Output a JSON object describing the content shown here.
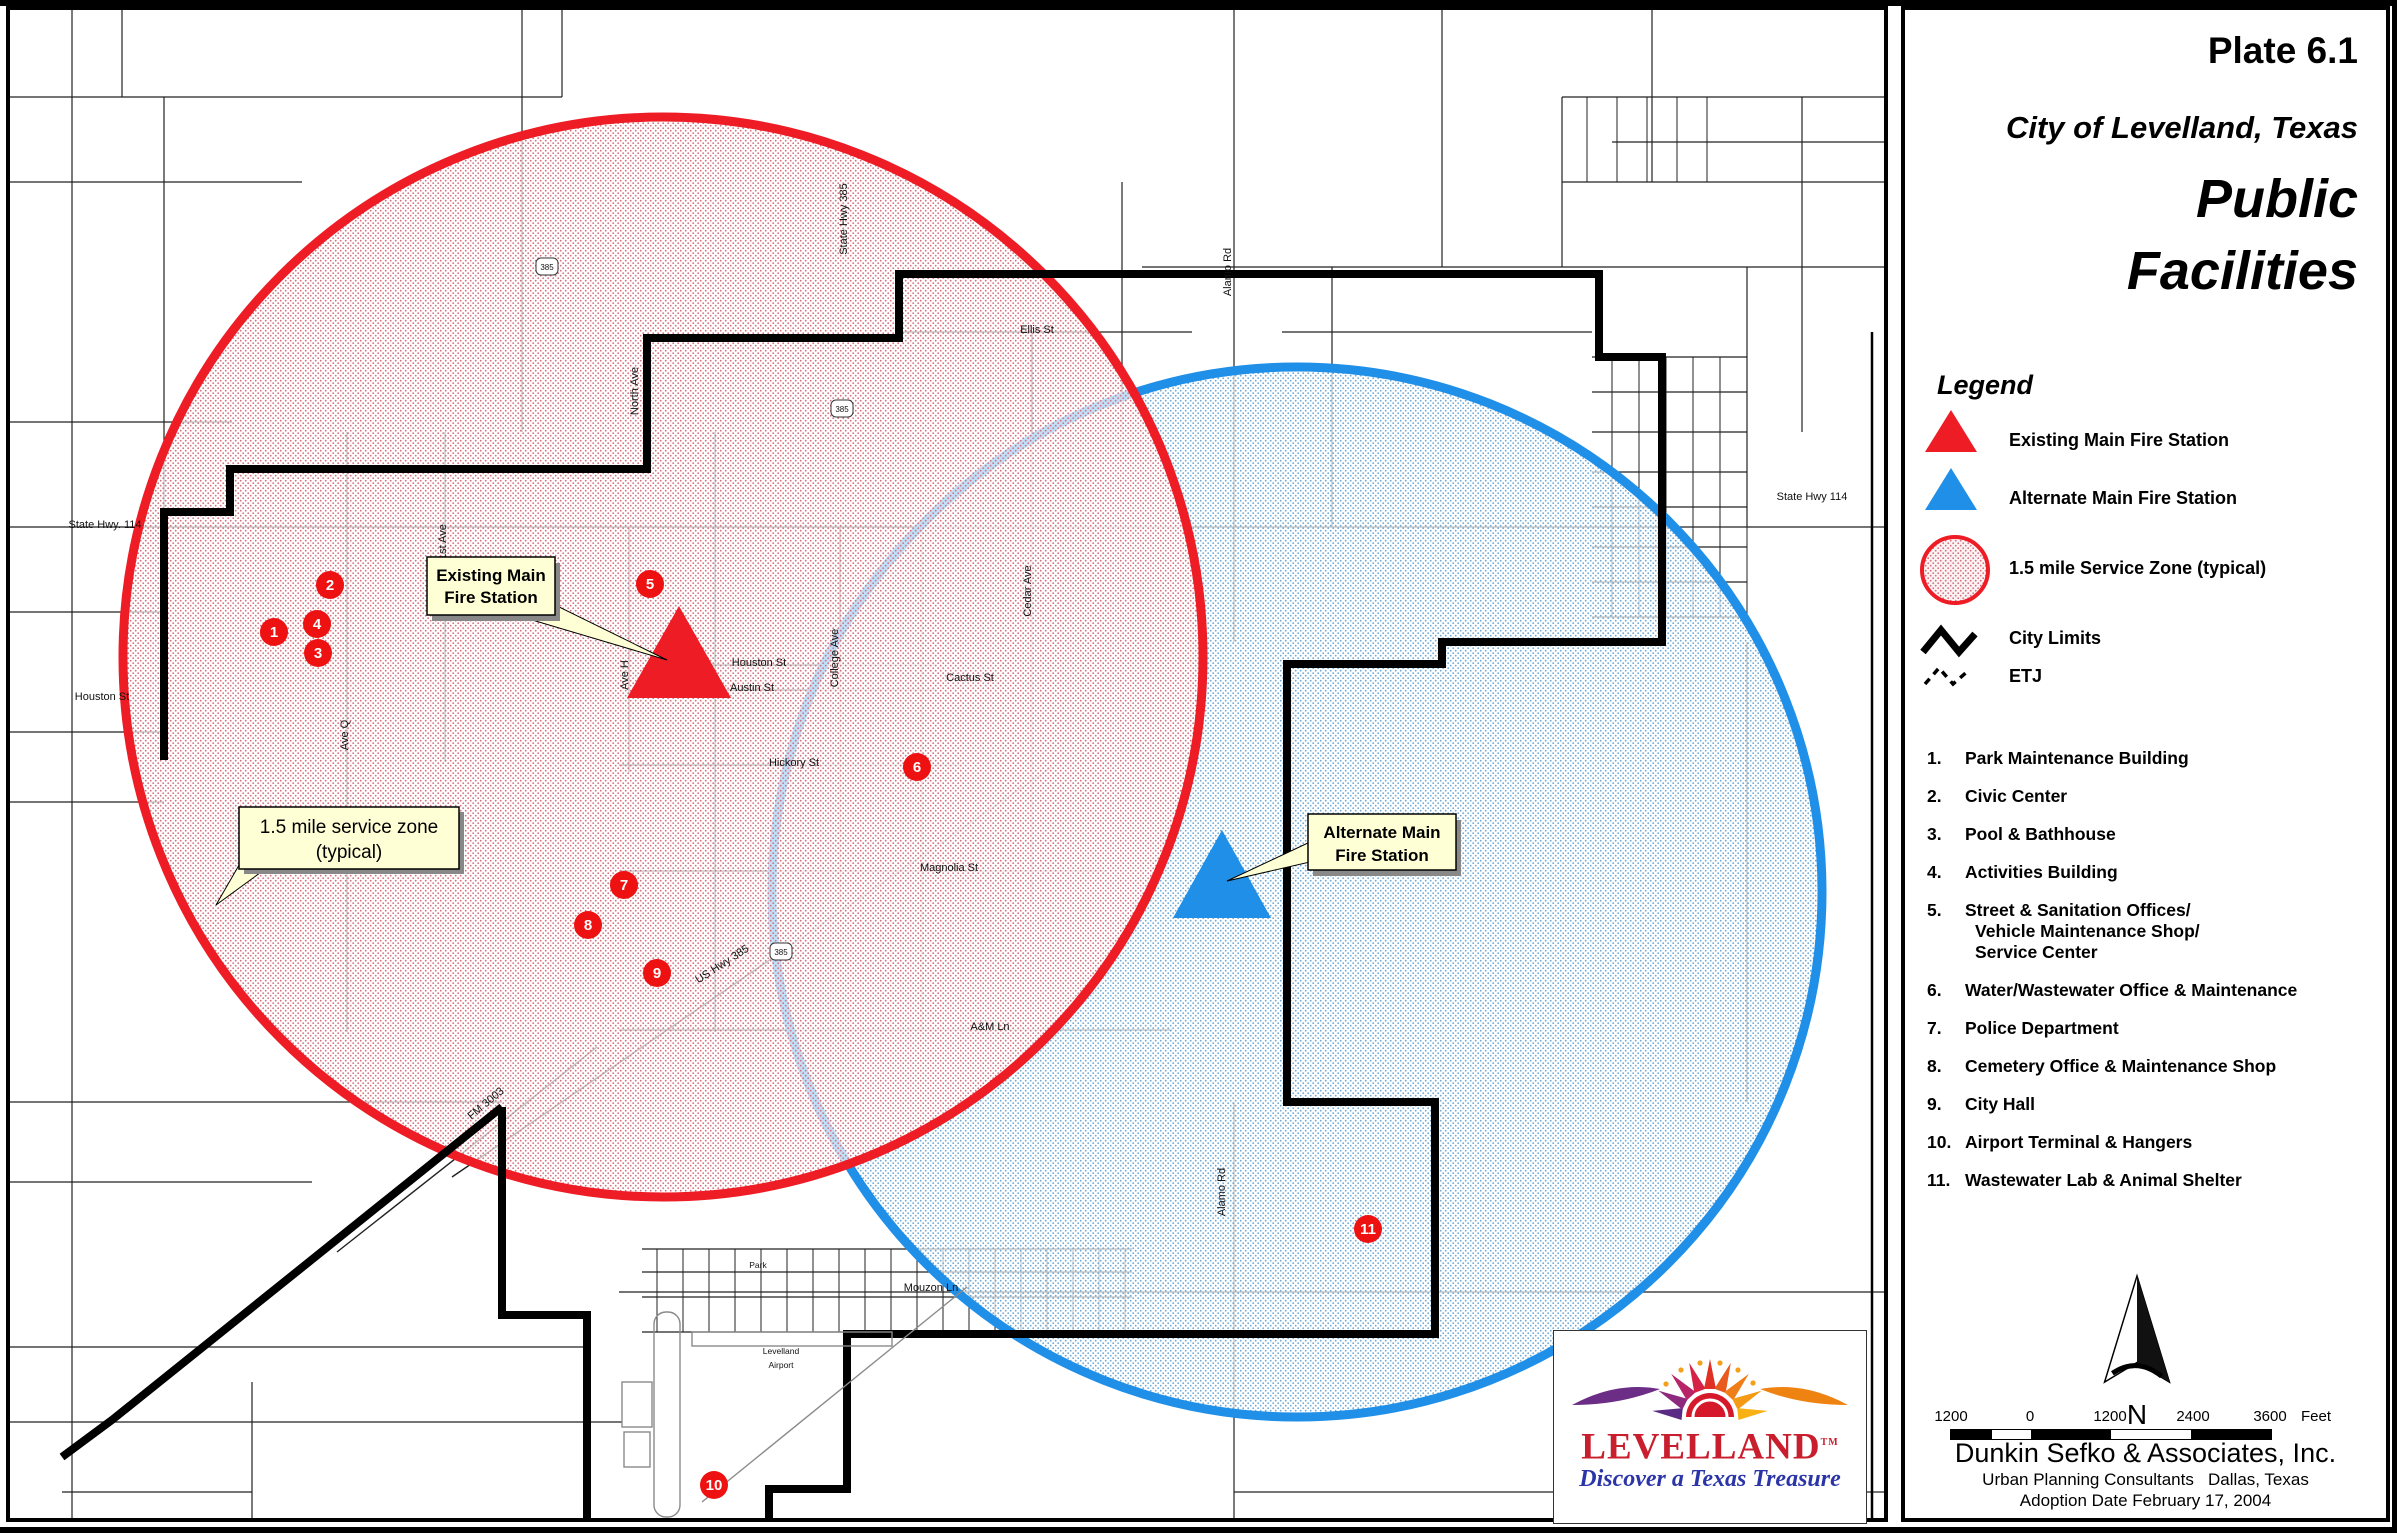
{
  "colors": {
    "red": "#ee1c25",
    "blue": "#1f8fe8",
    "callout_bg": "#ffffd6",
    "marker": "#ee1111",
    "black": "#000000"
  },
  "panel": {
    "plate": "Plate 6.1",
    "city": "City of Levelland, Texas",
    "title1": "Public",
    "title2": "Facilities",
    "legend": {
      "heading": "Legend",
      "items": [
        {
          "icon": "existing-fire-station-triangle",
          "label": "Existing Main Fire Station"
        },
        {
          "icon": "alternate-fire-station-triangle",
          "label": "Alternate Main Fire Station"
        },
        {
          "icon": "service-zone-circle",
          "label": "1.5 mile Service Zone (typical)"
        },
        {
          "icon": "city-limits-line",
          "label": "City Limits"
        },
        {
          "icon": "etj-line",
          "label": "ETJ"
        }
      ]
    },
    "facilities": [
      {
        "num": "1.",
        "lines": [
          "Park Maintenance Building"
        ]
      },
      {
        "num": "2.",
        "lines": [
          "Civic Center"
        ]
      },
      {
        "num": "3.",
        "lines": [
          "Pool & Bathhouse"
        ]
      },
      {
        "num": "4.",
        "lines": [
          "Activities Building"
        ]
      },
      {
        "num": "5.",
        "lines": [
          "Street & Sanitation Offices/",
          "Vehicle Maintenance Shop/",
          "Service Center"
        ]
      },
      {
        "num": "6.",
        "lines": [
          "Water/Wastewater Office & Maintenance"
        ]
      },
      {
        "num": "7.",
        "lines": [
          "Police Department"
        ]
      },
      {
        "num": "8.",
        "lines": [
          "Cemetery Office & Maintenance Shop"
        ]
      },
      {
        "num": "9.",
        "lines": [
          "City Hall"
        ]
      },
      {
        "num": "10.",
        "lines": [
          "Airport Terminal & Hangers"
        ]
      },
      {
        "num": "11.",
        "lines": [
          "Wastewater Lab & Animal Shelter"
        ]
      }
    ],
    "north_label": "N",
    "scale": {
      "labels": [
        "1200",
        "0",
        "1200",
        "2400",
        "3600"
      ],
      "unit": "Feet"
    },
    "firm": "Dunkin Sefko & Associates, Inc.",
    "firm_sub": "Urban Planning Consultants   Dallas, Texas",
    "adoption": "Adoption Date February 17, 2004"
  },
  "map": {
    "callouts": {
      "existing": {
        "line1": "Existing Main",
        "line2": "Fire Station"
      },
      "alternate": {
        "line1": "Alternate Main",
        "line2": "Fire Station"
      },
      "zone": {
        "line1": "1.5 mile service zone",
        "line2": "(typical)"
      }
    },
    "zones": {
      "red": {
        "label": "Existing Main Fire Station 1.5 mile service zone",
        "cx": 661,
        "cy": 655,
        "r": 540
      },
      "blue": {
        "label": "Alternate Main Fire Station 1.5 mile service zone",
        "cx": 1295,
        "cy": 890,
        "r": 525
      }
    },
    "markers": [
      {
        "n": "1",
        "x": 272,
        "y": 630
      },
      {
        "n": "2",
        "x": 328,
        "y": 583
      },
      {
        "n": "3",
        "x": 316,
        "y": 651
      },
      {
        "n": "4",
        "x": 315,
        "y": 622
      },
      {
        "n": "5",
        "x": 648,
        "y": 582
      },
      {
        "n": "6",
        "x": 915,
        "y": 765
      },
      {
        "n": "7",
        "x": 622,
        "y": 883
      },
      {
        "n": "8",
        "x": 586,
        "y": 923
      },
      {
        "n": "9",
        "x": 655,
        "y": 971
      },
      {
        "n": "10",
        "x": 712,
        "y": 1483
      },
      {
        "n": "11",
        "x": 1366,
        "y": 1227
      }
    ],
    "shields": [
      {
        "text": "385",
        "x": 545,
        "y": 265
      },
      {
        "text": "385",
        "x": 840,
        "y": 407
      },
      {
        "text": "385",
        "x": 779,
        "y": 950
      }
    ],
    "street_labels": [
      {
        "text": "State Hwy. 114",
        "x": 103,
        "y": 526,
        "rot": 0
      },
      {
        "text": "Houston St",
        "x": 100,
        "y": 698,
        "rot": 0
      },
      {
        "text": "1st Ave",
        "x": 444,
        "y": 540,
        "rot": -90
      },
      {
        "text": "Ave Q",
        "x": 346,
        "y": 733,
        "rot": -90
      },
      {
        "text": "Ave H",
        "x": 626,
        "y": 673,
        "rot": -90
      },
      {
        "text": "North Ave",
        "x": 636,
        "y": 389,
        "rot": -90
      },
      {
        "text": "State Hwy 385",
        "x": 845,
        "y": 217,
        "rot": -90
      },
      {
        "text": "Ellis St",
        "x": 1035,
        "y": 331,
        "rot": 0
      },
      {
        "text": "Houston St",
        "x": 757,
        "y": 664,
        "rot": 0
      },
      {
        "text": "Austin St",
        "x": 750,
        "y": 689,
        "rot": 0
      },
      {
        "text": "College Ave",
        "x": 836,
        "y": 656,
        "rot": -90
      },
      {
        "text": "Cedar Ave",
        "x": 1029,
        "y": 589,
        "rot": -90
      },
      {
        "text": "Cactus St",
        "x": 968,
        "y": 679,
        "rot": 0
      },
      {
        "text": "Hickory St",
        "x": 792,
        "y": 764,
        "rot": 0
      },
      {
        "text": "Magnolia St",
        "x": 947,
        "y": 869,
        "rot": 0
      },
      {
        "text": "US Hwy 385",
        "x": 722,
        "y": 965,
        "rot": -33
      },
      {
        "text": "A&M Ln",
        "x": 988,
        "y": 1028,
        "rot": 0
      },
      {
        "text": "Alamo Rd",
        "x": 1229,
        "y": 270,
        "rot": -90
      },
      {
        "text": "Alamo Rd",
        "x": 1223,
        "y": 1190,
        "rot": -90
      },
      {
        "text": "State Hwy 114",
        "x": 1810,
        "y": 498,
        "rot": 0
      },
      {
        "text": "Mouzon Ln",
        "x": 929,
        "y": 1289,
        "rot": 0
      },
      {
        "text": "FM 3003",
        "x": 486,
        "y": 1104,
        "rot": -40
      },
      {
        "text": "Levelland",
        "x": 779,
        "y": 1352,
        "rot": 0,
        "small": true
      },
      {
        "text": "Airport",
        "x": 779,
        "y": 1366,
        "rot": 0,
        "small": true
      },
      {
        "text": "Park",
        "x": 756,
        "y": 1266,
        "rot": 0,
        "small": true
      }
    ],
    "logo": {
      "name": "LEVELLAND",
      "tm": "TM",
      "tagline": "Discover a Texas Treasure"
    }
  }
}
